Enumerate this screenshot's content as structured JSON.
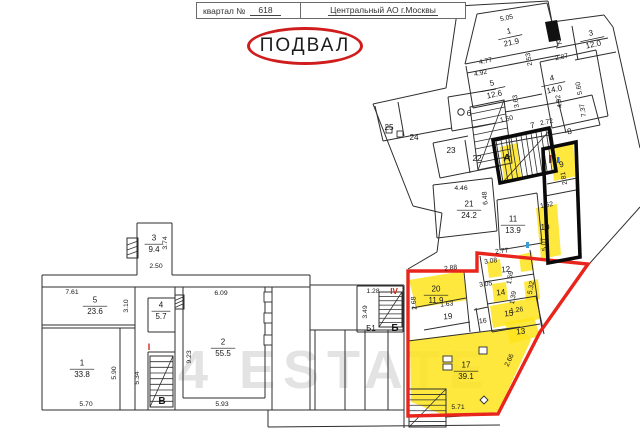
{
  "header": {
    "left_label": "квартал №",
    "left_value": "618",
    "right_value": "Центральный АО г.Москвы"
  },
  "title": "ПОДВАЛ",
  "watermark": "4 ESTATE",
  "colors": {
    "highlight": "#ffe41c",
    "red_outline": "#e8251c",
    "black_outline": "#0a0a0a",
    "wall": "#2e2e2e",
    "red_mark": "#cc2211",
    "blue_mark": "#3a6fd8",
    "watermark": "#e3e3e3",
    "title_circle": "#cf1d1d"
  },
  "plan": {
    "walls": [
      [
        42,
        275,
        137,
        275
      ],
      [
        172,
        275,
        310,
        275
      ],
      [
        42,
        275,
        42,
        410
      ],
      [
        42,
        410,
        404,
        410
      ],
      [
        42,
        287,
        310,
        287
      ],
      [
        310,
        275,
        310,
        410
      ],
      [
        137,
        223,
        172,
        223
      ],
      [
        137,
        223,
        137,
        275
      ],
      [
        172,
        223,
        172,
        275
      ],
      [
        135,
        287,
        135,
        410
      ],
      [
        42,
        325,
        135,
        325
      ],
      [
        120,
        328,
        120,
        410
      ],
      [
        42,
        328,
        135,
        328
      ],
      [
        148,
        298,
        148,
        332
      ],
      [
        148,
        352,
        148,
        410
      ],
      [
        175,
        287,
        175,
        410
      ],
      [
        148,
        298,
        175,
        298
      ],
      [
        148,
        332,
        175,
        332
      ],
      [
        148,
        352,
        175,
        352
      ],
      [
        183,
        287,
        183,
        398
      ],
      [
        265,
        287,
        265,
        398
      ],
      [
        183,
        398,
        265,
        398
      ],
      [
        272,
        287,
        272,
        410
      ],
      [
        310,
        330,
        404,
        330
      ],
      [
        315,
        330,
        315,
        410
      ],
      [
        345,
        330,
        345,
        410
      ],
      [
        365,
        330,
        365,
        410
      ],
      [
        388,
        330,
        388,
        410
      ],
      [
        404,
        285,
        404,
        428
      ],
      [
        310,
        285,
        404,
        285
      ],
      [
        357,
        286,
        357,
        332
      ],
      [
        403,
        286,
        403,
        332
      ],
      [
        357,
        332,
        403,
        332
      ],
      [
        357,
        286,
        403,
        286
      ],
      [
        268,
        410,
        268,
        427
      ],
      [
        268,
        427,
        500,
        425
      ],
      [
        458,
        6,
        446,
        88
      ],
      [
        446,
        88,
        373,
        104
      ],
      [
        373,
        104,
        413,
        206
      ],
      [
        413,
        206,
        442,
        213
      ],
      [
        442,
        213,
        437,
        252
      ],
      [
        437,
        252,
        408,
        269
      ],
      [
        458,
        6,
        548,
        1
      ],
      [
        548,
        1,
        552,
        22
      ],
      [
        552,
        22,
        604,
        15
      ],
      [
        604,
        15,
        613,
        27
      ],
      [
        613,
        27,
        640,
        148
      ],
      [
        640,
        207,
        590,
        263
      ],
      [
        477,
        14,
        547,
        3
      ],
      [
        477,
        14,
        465,
        64
      ],
      [
        465,
        64,
        558,
        46
      ],
      [
        467,
        73,
        560,
        55
      ],
      [
        547,
        3,
        558,
        46
      ],
      [
        572,
        26,
        578,
        60
      ],
      [
        556,
        48,
        608,
        38
      ],
      [
        575,
        60,
        616,
        52
      ],
      [
        540,
        62,
        596,
        50
      ],
      [
        540,
        62,
        552,
        128
      ],
      [
        596,
        50,
        608,
        116
      ],
      [
        552,
        128,
        608,
        116
      ],
      [
        466,
        66,
        473,
        108
      ],
      [
        473,
        108,
        542,
        94
      ],
      [
        448,
        97,
        452,
        131
      ],
      [
        452,
        131,
        496,
        123
      ],
      [
        448,
        97,
        496,
        89
      ],
      [
        375,
        106,
        383,
        141
      ],
      [
        383,
        141,
        452,
        128
      ],
      [
        398,
        102,
        404,
        136
      ],
      [
        433,
        143,
        440,
        178
      ],
      [
        440,
        178,
        500,
        166
      ],
      [
        465,
        140,
        470,
        173
      ],
      [
        433,
        143,
        468,
        136
      ],
      [
        505,
        112,
        560,
        102
      ],
      [
        560,
        102,
        592,
        95
      ],
      [
        558,
        100,
        566,
        133
      ],
      [
        510,
        142,
        566,
        132
      ],
      [
        566,
        132,
        600,
        125
      ],
      [
        592,
        95,
        600,
        125
      ],
      [
        433,
        185,
        492,
        178
      ],
      [
        433,
        185,
        437,
        238
      ],
      [
        437,
        238,
        497,
        231
      ],
      [
        492,
        178,
        497,
        231
      ],
      [
        497,
        200,
        537,
        193
      ],
      [
        497,
        200,
        500,
        250
      ],
      [
        537,
        193,
        542,
        243
      ],
      [
        500,
        250,
        542,
        243
      ],
      [
        547,
        184,
        577,
        178
      ],
      [
        545,
        196,
        576,
        190
      ],
      [
        412,
        308,
        466,
        298
      ],
      [
        464,
        272,
        470,
        332
      ],
      [
        424,
        330,
        470,
        322
      ],
      [
        480,
        256,
        492,
        332
      ],
      [
        530,
        250,
        542,
        330
      ],
      [
        484,
        282,
        534,
        274
      ],
      [
        487,
        304,
        537,
        296
      ],
      [
        492,
        332,
        540,
        324
      ],
      [
        476,
        308,
        480,
        332
      ],
      [
        474,
        310,
        488,
        307
      ],
      [
        536,
        296,
        544,
        334
      ],
      [
        408,
        341,
        520,
        327
      ],
      [
        445,
        417,
        498,
        414
      ],
      [
        446,
        389,
        446,
        427
      ]
    ],
    "hatched": [
      [
        127,
        238,
        11,
        20
      ],
      [
        175,
        295,
        9,
        14
      ]
    ],
    "rects": [
      [
        264,
        292,
        8,
        10
      ],
      [
        264,
        313,
        8,
        10
      ],
      [
        264,
        335,
        8,
        10
      ],
      [
        386,
        127,
        6,
        6
      ],
      [
        397,
        131,
        6,
        6
      ],
      [
        443,
        356,
        9,
        6
      ],
      [
        443,
        364,
        9,
        6
      ],
      [
        479,
        347,
        8,
        7
      ]
    ],
    "diamonds": [
      [
        484,
        396,
        488,
        400,
        484,
        404,
        480,
        400
      ]
    ],
    "blackfills": [
      [
        545,
        22,
        557,
        20,
        561,
        40,
        549,
        42
      ]
    ],
    "circles": [
      [
        461,
        112,
        3.2
      ]
    ],
    "ticks": [
      [
        549,
        155,
        2.5,
        8,
        "#cc2211"
      ],
      [
        553,
        154,
        2.5,
        8,
        "#cc2211"
      ],
      [
        557,
        157,
        2.5,
        6,
        "#3a6fd8"
      ],
      [
        526,
        242,
        3,
        6,
        "#3a9fd8"
      ]
    ],
    "stairs": [
      {
        "q": [
          [
            496,
            141
          ],
          [
            551,
            129
          ],
          [
            557,
            170
          ],
          [
            503,
            182
          ]
        ],
        "n": 11,
        "v": 0,
        "d": 1
      },
      {
        "q": [
          [
            470,
            107
          ],
          [
            504,
            100
          ],
          [
            512,
            163
          ],
          [
            478,
            170
          ]
        ],
        "n": 9,
        "v": 1,
        "d": 1
      },
      {
        "q": [
          [
            379,
            292
          ],
          [
            402,
            292
          ],
          [
            402,
            327
          ],
          [
            379,
            327
          ]
        ],
        "n": 8,
        "v": 1,
        "d": 1
      },
      {
        "q": [
          [
            150,
            356
          ],
          [
            173,
            356
          ],
          [
            173,
            407
          ],
          [
            150,
            407
          ]
        ],
        "n": 9,
        "v": 1,
        "d": 1
      },
      {
        "q": [
          [
            409,
            389
          ],
          [
            446,
            389
          ],
          [
            446,
            427
          ],
          [
            409,
            427
          ]
        ],
        "n": 7,
        "v": 1,
        "d": 1
      }
    ],
    "yellow": [
      [
        409,
        280,
        463,
        271,
        467,
        300,
        416,
        308
      ],
      [
        410,
        340,
        522,
        327,
        531,
        340,
        498,
        412,
        446,
        416,
        411,
        402
      ],
      [
        505,
        322,
        534,
        317,
        540,
        336,
        510,
        344
      ],
      [
        490,
        306,
        537,
        297,
        540,
        319,
        493,
        328
      ],
      [
        524,
        282,
        538,
        279,
        540,
        299,
        526,
        301
      ],
      [
        492,
        284,
        506,
        282,
        508,
        300,
        494,
        302
      ],
      [
        487,
        262,
        500,
        259,
        502,
        276,
        489,
        278
      ],
      [
        519,
        255,
        532,
        252,
        534,
        270,
        521,
        272
      ],
      [
        536,
        208,
        557,
        204,
        561,
        255,
        541,
        259
      ],
      [
        550,
        149,
        573,
        144,
        577,
        176,
        554,
        181
      ],
      [
        500,
        147,
        517,
        143,
        521,
        177,
        504,
        181
      ]
    ],
    "red": [
      408,
      271,
      477,
      271,
      477,
      253,
      588,
      264,
      540,
      332,
      498,
      414,
      408,
      416
    ],
    "black": [
      [
        493,
        140,
        549,
        128,
        556,
        171,
        500,
        183
      ],
      [
        543,
        149,
        576,
        142,
        580,
        257,
        548,
        263
      ]
    ],
    "rooms": [
      {
        "n": "3",
        "a": "9.4",
        "x": 154,
        "y": 243
      },
      {
        "n": "5",
        "a": "23.6",
        "x": 95,
        "y": 305
      },
      {
        "n": "4",
        "a": "5.7",
        "x": 161,
        "y": 310
      },
      {
        "n": "1",
        "a": "33.8",
        "x": 82,
        "y": 368
      },
      {
        "n": "2",
        "a": "55.5",
        "x": 223,
        "y": 347
      },
      {
        "n": "1",
        "a": "21.9",
        "x": 510,
        "y": 36,
        "r": -12
      },
      {
        "n": "3",
        "a": "12.0",
        "x": 592,
        "y": 38,
        "r": -12
      },
      {
        "n": "4",
        "a": "14.0",
        "x": 553,
        "y": 83,
        "r": -12
      },
      {
        "n": "5",
        "a": "12.6",
        "x": 493,
        "y": 88,
        "r": -12
      },
      {
        "n": "21",
        "a": "24.2",
        "x": 469,
        "y": 209
      },
      {
        "n": "11",
        "a": "13.9",
        "x": 513,
        "y": 224
      },
      {
        "n": "20",
        "a": "11.9",
        "x": 436,
        "y": 294
      },
      {
        "n": "17",
        "a": "39.1",
        "x": 466,
        "y": 370
      }
    ],
    "labels": [
      {
        "t": "2",
        "x": 560,
        "y": 44,
        "r": -12
      },
      {
        "t": "6",
        "x": 469,
        "y": 116
      },
      {
        "t": "7",
        "x": 533,
        "y": 128,
        "r": -12
      },
      {
        "t": "8",
        "x": 570,
        "y": 134,
        "r": -12
      },
      {
        "t": "9",
        "x": 562,
        "y": 167,
        "r": -12
      },
      {
        "t": "10",
        "x": 545,
        "y": 230
      },
      {
        "t": "12",
        "x": 506,
        "y": 272,
        "r": -6
      },
      {
        "t": "13",
        "x": 521,
        "y": 334,
        "r": -6
      },
      {
        "t": "14",
        "x": 501,
        "y": 295,
        "r": -6
      },
      {
        "t": "15",
        "x": 509,
        "y": 316,
        "r": -6
      },
      {
        "t": "16",
        "x": 483,
        "y": 323,
        "r": -6,
        "s": 7
      },
      {
        "t": "19",
        "x": 448,
        "y": 319,
        "r": -4
      },
      {
        "t": "22",
        "x": 477,
        "y": 161
      },
      {
        "t": "23",
        "x": 451,
        "y": 153
      },
      {
        "t": "24",
        "x": 414,
        "y": 140
      },
      {
        "t": "25",
        "x": 389,
        "y": 130
      },
      {
        "t": "А",
        "x": 507,
        "y": 161,
        "b": 1,
        "s": 10
      },
      {
        "t": "Б",
        "x": 395,
        "y": 331,
        "b": 1,
        "s": 10
      },
      {
        "t": "Б1",
        "x": 371,
        "y": 331,
        "s": 8
      },
      {
        "t": "В",
        "x": 162,
        "y": 404,
        "b": 1,
        "s": 10
      },
      {
        "t": "I",
        "x": 149,
        "y": 350,
        "c": "#cc2211",
        "b": 1,
        "s": 9
      },
      {
        "t": "IV",
        "x": 394,
        "y": 294,
        "c": "#cc2211",
        "b": 1,
        "s": 8
      }
    ],
    "dims": [
      {
        "t": "3.74",
        "x": 167,
        "y": 243,
        "r": -90
      },
      {
        "t": "2.50",
        "x": 156,
        "y": 268
      },
      {
        "t": "7.61",
        "x": 72,
        "y": 294
      },
      {
        "t": "3.10",
        "x": 128,
        "y": 306,
        "r": -90
      },
      {
        "t": "6.09",
        "x": 221,
        "y": 295
      },
      {
        "t": "9.23",
        "x": 191,
        "y": 357,
        "r": -90
      },
      {
        "t": "5.90",
        "x": 116,
        "y": 373,
        "r": -90
      },
      {
        "t": "5.34",
        "x": 139,
        "y": 378,
        "r": -90
      },
      {
        "t": "5.70",
        "x": 86,
        "y": 406
      },
      {
        "t": "5.93",
        "x": 222,
        "y": 406
      },
      {
        "t": "1.28",
        "x": 373,
        "y": 293
      },
      {
        "t": "3.49",
        "x": 367,
        "y": 312,
        "r": -90
      },
      {
        "t": "5.05",
        "x": 507,
        "y": 20,
        "r": -12
      },
      {
        "t": "2.53",
        "x": 531,
        "y": 59,
        "r": -100
      },
      {
        "t": "4.77",
        "x": 486,
        "y": 63,
        "r": -12
      },
      {
        "t": "4.92",
        "x": 481,
        "y": 75,
        "r": -12
      },
      {
        "t": "2.87",
        "x": 562,
        "y": 59,
        "r": -12
      },
      {
        "t": "5.60",
        "x": 581,
        "y": 88,
        "r": -100
      },
      {
        "t": "4.92",
        "x": 561,
        "y": 101,
        "r": -100
      },
      {
        "t": "7.37",
        "x": 585,
        "y": 110,
        "r": -100
      },
      {
        "t": "3.63",
        "x": 518,
        "y": 101,
        "r": -100
      },
      {
        "t": "1.50",
        "x": 507,
        "y": 121,
        "r": -12
      },
      {
        "t": "2.72",
        "x": 547,
        "y": 124,
        "r": -12
      },
      {
        "t": "2.81",
        "x": 566,
        "y": 178,
        "r": -100
      },
      {
        "t": "1.52",
        "x": 547,
        "y": 207,
        "r": -10
      },
      {
        "t": "5.07",
        "x": 546,
        "y": 244,
        "r": -97
      },
      {
        "t": "4.46",
        "x": 461,
        "y": 190
      },
      {
        "t": "6.48",
        "x": 487,
        "y": 198,
        "r": -95
      },
      {
        "t": "2.77",
        "x": 502,
        "y": 253,
        "r": -6
      },
      {
        "t": "3.08",
        "x": 491,
        "y": 263,
        "r": -8
      },
      {
        "t": "2.88",
        "x": 451,
        "y": 270,
        "r": -8
      },
      {
        "t": "2.68",
        "x": 416,
        "y": 303,
        "r": -95
      },
      {
        "t": "1.63",
        "x": 447,
        "y": 306,
        "r": -6
      },
      {
        "t": "3.05",
        "x": 486,
        "y": 286,
        "r": -8
      },
      {
        "t": "1.59",
        "x": 512,
        "y": 278,
        "r": -80
      },
      {
        "t": "1.39",
        "x": 515,
        "y": 298,
        "r": -80
      },
      {
        "t": "5.32",
        "x": 533,
        "y": 288,
        "r": -80
      },
      {
        "t": "1.26",
        "x": 517,
        "y": 312,
        "r": -8
      },
      {
        "t": "2.66",
        "x": 511,
        "y": 361,
        "r": -65
      },
      {
        "t": "5.71",
        "x": 458,
        "y": 409
      }
    ]
  }
}
